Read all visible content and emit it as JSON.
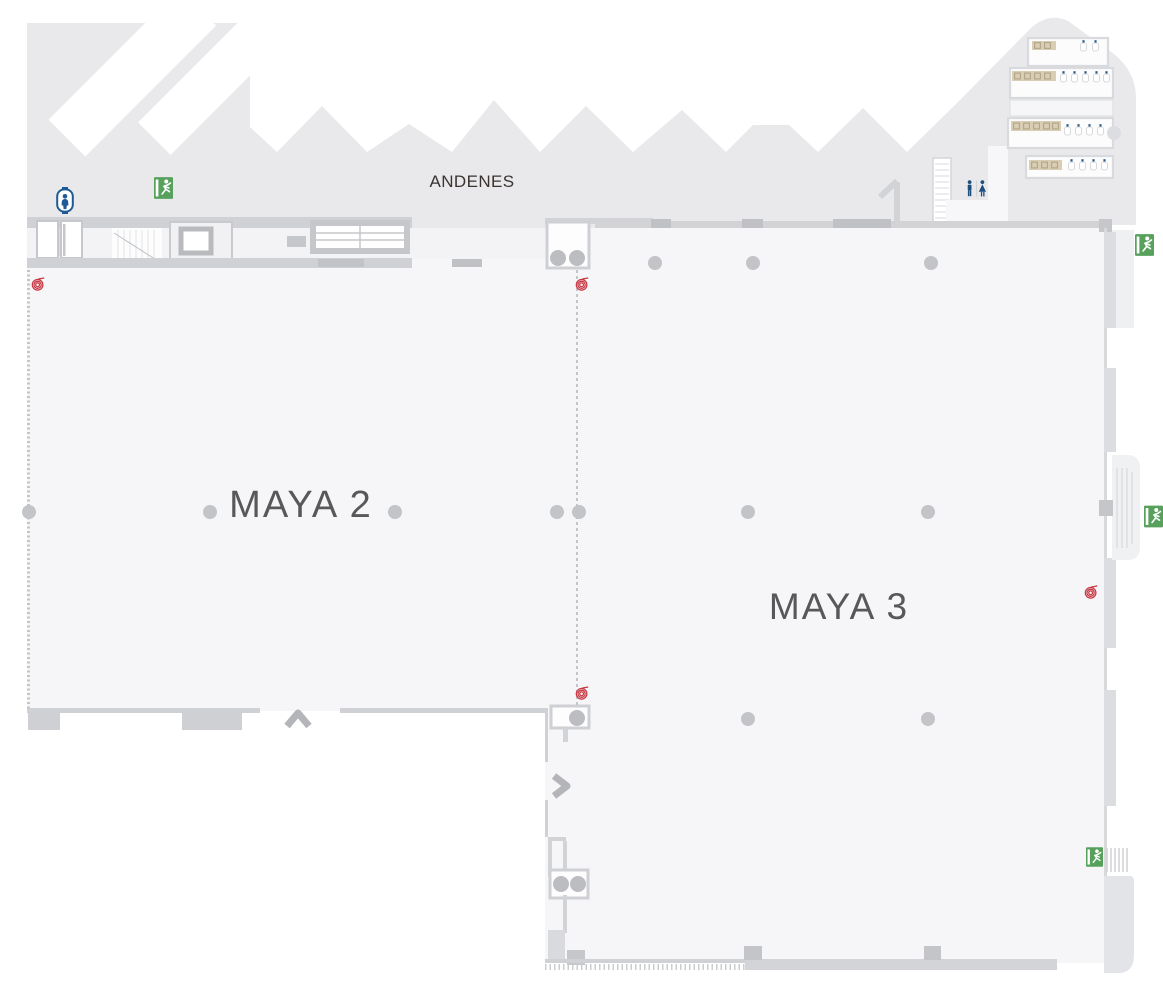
{
  "map": {
    "labels": {
      "andenes": "ANDENES",
      "maya2": "MAYA 2",
      "maya3": "MAYA 3"
    },
    "icons": [
      {
        "name": "elevator-icon",
        "count": 1
      },
      {
        "name": "emergency-exit-icon",
        "count": 4
      },
      {
        "name": "restrooms-icon",
        "count": 1
      },
      {
        "name": "fire-hose-reel-icon",
        "count": 4
      }
    ],
    "colors": {
      "hall_fill": "#f6f6f8",
      "dock_fill": "#e9e9eb",
      "corridor_fill": "#f3f3f5",
      "wall": "#cfd1d4",
      "wall_dark": "#c0c1c5",
      "column_dot": "#c3c4c8",
      "exit_green": "#57a15d",
      "elevator_blue": "#1d5a96",
      "restroom_blue": "#1d4f7c",
      "fire_red": "#c83943",
      "sink_beige": "#d9cdb3",
      "sink_dark": "#b3a88c",
      "label_dark": "#3a3431",
      "label_gray": "#58585b"
    }
  }
}
